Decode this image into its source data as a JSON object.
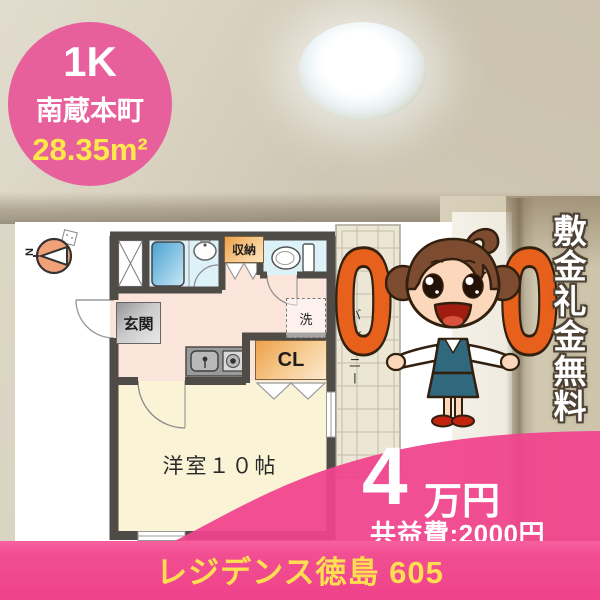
{
  "badge": {
    "plan": "1K",
    "location": "南蔵本町",
    "area": "28.35m²"
  },
  "floorplan": {
    "compass": "N",
    "labels": {
      "entrance": "玄関",
      "storage": "収納",
      "laundry": "洗",
      "closet": "CL",
      "main_room": "洋室１０帖",
      "balcony": "バルコニー"
    }
  },
  "promo": {
    "zero": "0",
    "no_deposit_text": "敷金礼金無料"
  },
  "price": {
    "amount": "4",
    "unit": "万円",
    "common_fee": "共益費:2000円"
  },
  "footer": {
    "building_name": "レジデンス徳島 605"
  },
  "colors": {
    "brand_pink": "#ef4f90",
    "badge_pink": "#e7609b",
    "accent_yellow": "#ffe24d",
    "promo_orange": "#e8611c",
    "wall_gray": "#4f4b47",
    "room_cream": "#faf3d6",
    "hall_pink": "#fbe5da",
    "wet_area_blue": "#ddf1f8"
  }
}
